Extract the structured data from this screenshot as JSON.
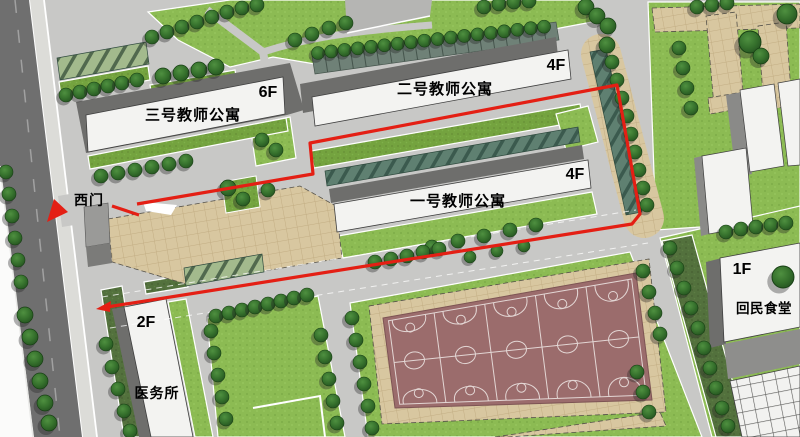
{
  "labels": {
    "building3": {
      "name": "三号教师公寓",
      "floors": "6F"
    },
    "building2": {
      "name": "二号教师公寓",
      "floors": "4F"
    },
    "building1": {
      "name": "一号教师公寓",
      "floors": "4F"
    },
    "clinic": {
      "name": "医务所",
      "floors": "2F"
    },
    "canteen": {
      "name": "回民食堂",
      "floors": "1F"
    },
    "west_gate": "西门"
  },
  "colors": {
    "route_red": "#e41f14",
    "court_maroon": "#9b6c6c",
    "lawn_green": "#8cbb53",
    "paving_tan": "#d8c7a0",
    "road_dark": "#6f6f6f",
    "road_light": "#c8c8c6",
    "building_white": "#f3f3f1",
    "tree_green": "#2f6a2c"
  }
}
